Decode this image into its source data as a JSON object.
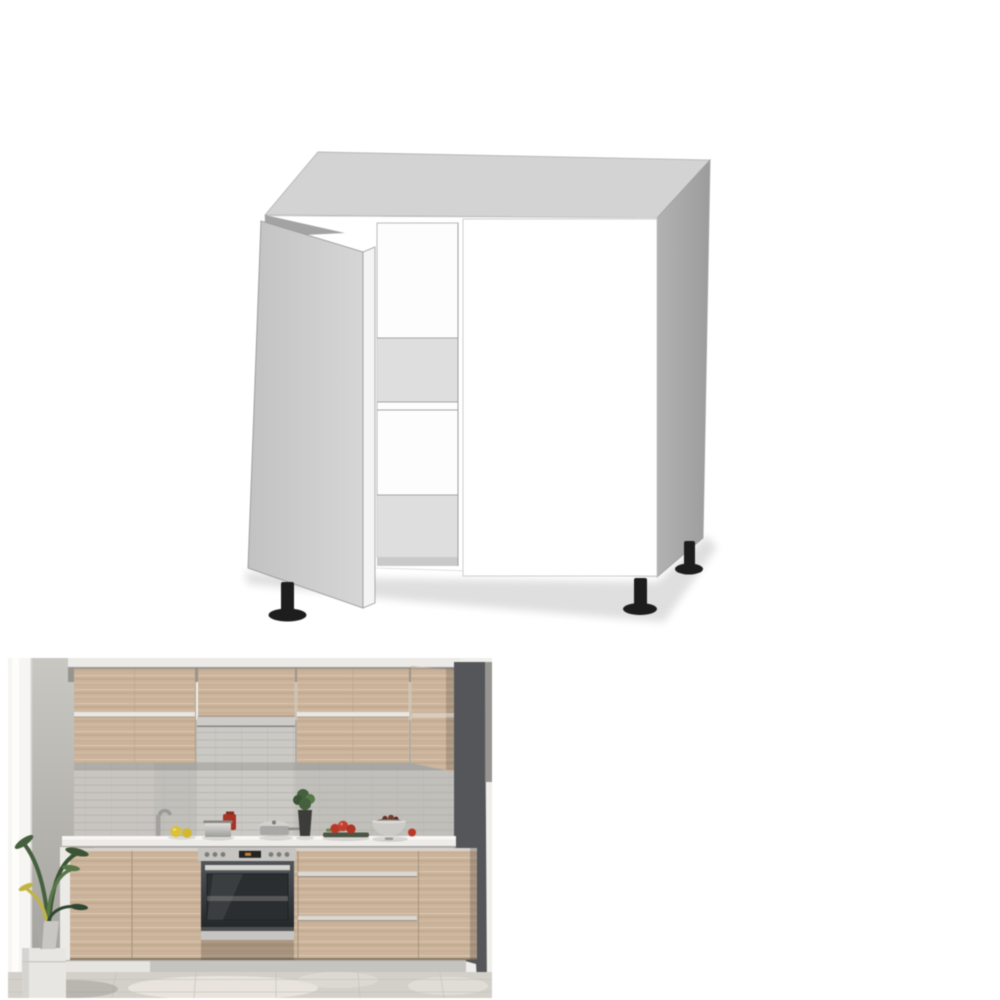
{
  "page": {
    "background": "#ffffff"
  },
  "figures": {
    "drawing": {
      "label": "base-cabinet-technical-drawing",
      "colors": {
        "top_face": "#d3d3d3",
        "side_face": "#a6a6a6",
        "front_face": "#ffffff",
        "door_face": "#c2c2c2",
        "door_face_light": "#d6d6d6",
        "door_edge": "#f4f4f4",
        "left_panel_sliver": "#a3a3a3",
        "interior_white": "#fdfdfd",
        "interior_band": "#dedede",
        "interior_bottom": "#c9c9c9",
        "outline": "#a8a8a8",
        "feet": "#1d1d1d",
        "shadow": "#dfdfdf"
      }
    },
    "photo": {
      "label": "kitchen-room-photo",
      "colors": {
        "window_wall": "#f6f5f2",
        "window_highlight": "#fdfdfc",
        "ceiling_white": "#eceae6",
        "ceiling_band": "#96948f",
        "dark_wall": "#54565a",
        "wall_edge": "#8d8b87",
        "tile": "#c1bfba",
        "tile_niche": "#cbc9c4",
        "wood": "#cbb399",
        "handle_strip": "#e9e7e3",
        "hood_steel": "#cdccc9",
        "countertop": "#eeece8",
        "end_panel": "#eceae7",
        "oven_steel": "#c6c5c2",
        "oven_glass": "#2b2e31",
        "plinth": "#c6c4c0",
        "floor": "#d3d0c9",
        "plant_green": "#44603c",
        "plant_green_light": "#567747",
        "plant_yellow": "#c2b33f",
        "pot_gray": "#c9c7c3",
        "lemon": "#dcc033",
        "tomato": "#bf3726",
        "red_canister": "#a93326",
        "board_green": "#4c5544",
        "bowl_steel": "#cbcac7",
        "bowl_contents": "#5a4136"
      }
    }
  }
}
